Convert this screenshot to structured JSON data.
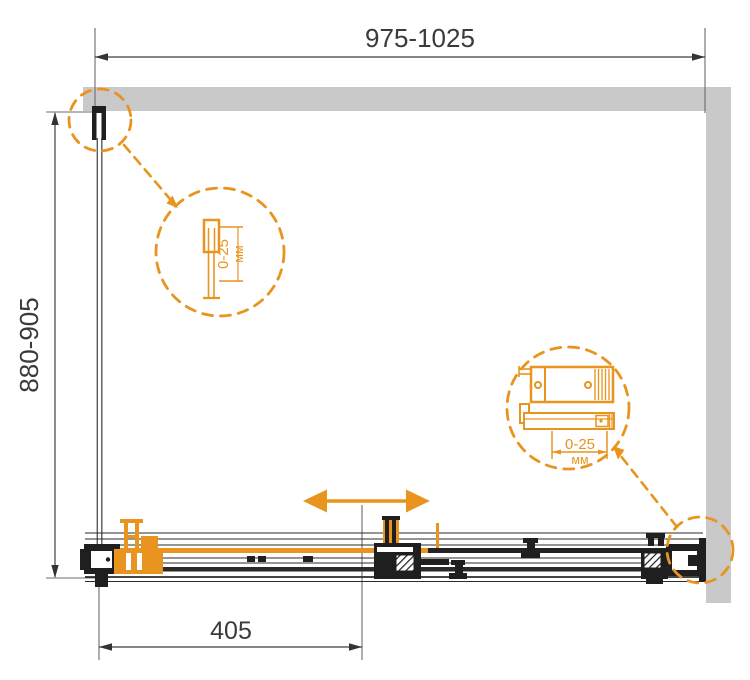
{
  "drawing": {
    "kind": "shower-enclosure-top-view-technical-drawing"
  },
  "colors": {
    "accent_orange": "#E8941F",
    "wall_gray": "#C9C9C9",
    "line_dark": "#1F1F1F",
    "dimension_text": "#3A3A3A"
  },
  "dimensions": {
    "overall_width": {
      "label": "975-1025"
    },
    "overall_depth": {
      "label": "880-905"
    },
    "door_offset": {
      "label": "405"
    }
  },
  "details": {
    "wall_profile": {
      "range": "0-25",
      "unit": "мм"
    },
    "wall_bracket": {
      "range": "0-25",
      "unit": "мм"
    }
  },
  "icons": [
    "slide-direction-arrow",
    "detail-circle",
    "callout-arrow"
  ]
}
